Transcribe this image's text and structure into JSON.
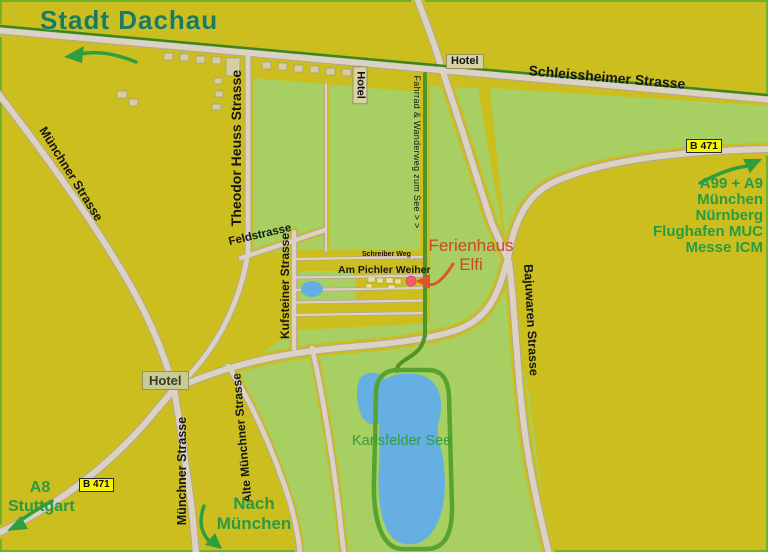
{
  "title": "Stadt Dachau",
  "streets": {
    "schleissheimer": "Schleissheimer Strasse",
    "theodor_heuss": "Theodor Heuss Strasse",
    "muenchner_nw": "Münchner Strasse",
    "feldstrasse": "Feldstrasse",
    "kufsteiner": "Kufsteiner Strasse",
    "schreiber_weg": "Schreiber Weg",
    "am_pichler_weiher": "Am Pichler Weiher",
    "bajuwaren": "Bajuwaren Strasse",
    "muenchner_s": "Münchner Strasse",
    "alte_muenchner": "Alte Münchner Strasse",
    "fahrrad_weg": "Fahrrad & Wanderweg zum See > >"
  },
  "badges": {
    "b471": "B 471",
    "hotel": "Hotel"
  },
  "poi": {
    "ferienhaus_line1": "Ferienhaus",
    "ferienhaus_line2": "Elfi",
    "lake": "Karlsfelder See"
  },
  "directions": {
    "ne": {
      "lines": [
        "A99 + A9",
        "München",
        "Nürnberg",
        "Flughafen MUC",
        "Messe ICM"
      ]
    },
    "sw": {
      "lines": [
        "A8",
        "Stuttgart"
      ]
    },
    "south": {
      "lines": [
        "Nach",
        "München"
      ]
    }
  },
  "colors": {
    "background": "#ccbe1e",
    "parkland": "#a7cf62",
    "road_fill": "#dbd2c4",
    "road_casing": "#b2a792",
    "lake_blue": "#65afe2",
    "trail_green": "#4f9428",
    "direction_text": "#2a9a45",
    "poi_text": "#ce4627",
    "badge_yellow": "#f8f500",
    "title_teal": "#1d7a5b"
  }
}
